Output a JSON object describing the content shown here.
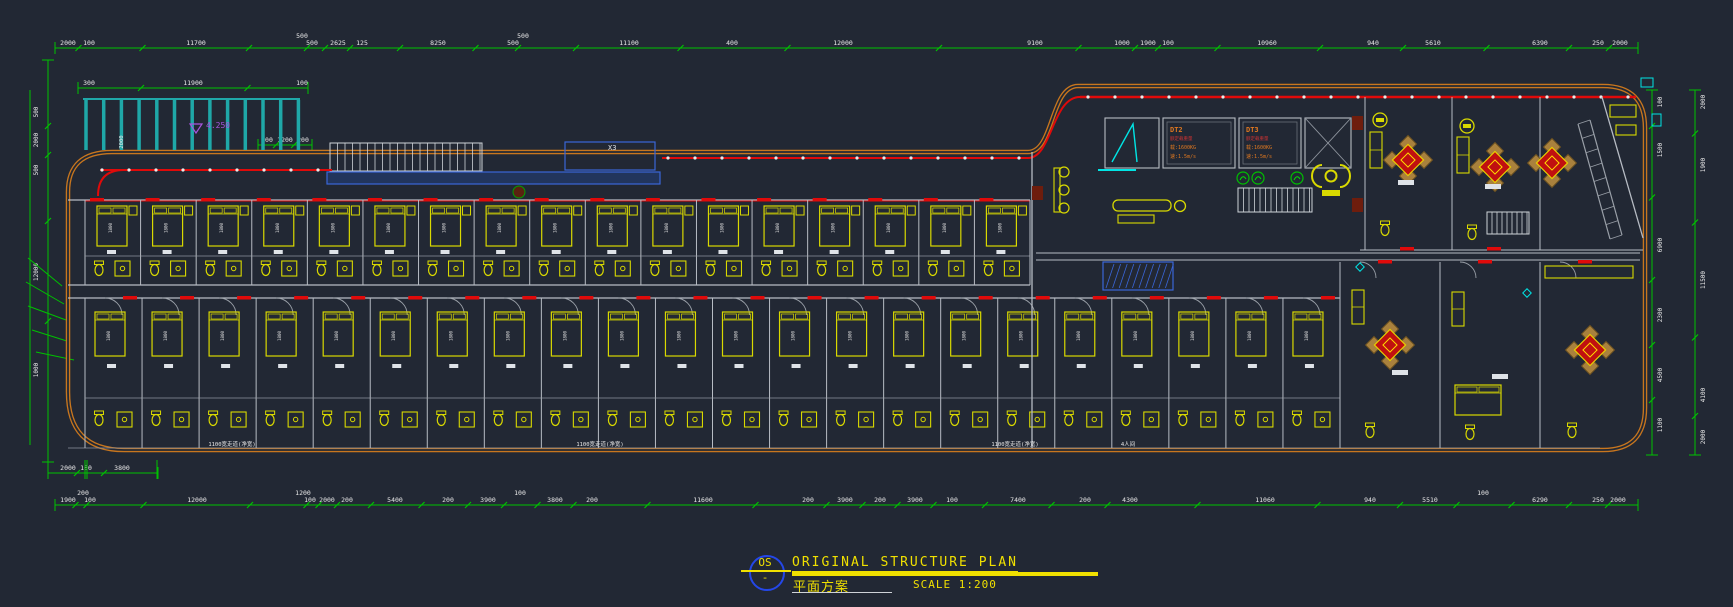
{
  "colors": {
    "bg": "#222834",
    "dim": "#00c200",
    "text": "#e9e9e9",
    "outline": "#c8761e",
    "red": "#e00a0a",
    "yellow": "#d9d900",
    "teal": "#1fa8a8",
    "cyan": "#00e5e5",
    "blue": "#3a66d8",
    "blue_fill": "#223f7d",
    "purple": "#a855e0",
    "wall": "#b7bcc4",
    "tan": "#a9813d",
    "maroon": "#6e1d0d",
    "title_yellow": "#f0e000",
    "circle_blue": "#2447e8",
    "spec_orange": "#e07820",
    "spec_red": "#cc3333"
  },
  "title_block": {
    "code": "OS",
    "dash": "-",
    "title_en": "ORIGINAL STRUCTURE PLAN",
    "title_cn": "平面方案",
    "scale_label": "SCALE 1:200"
  },
  "dims": {
    "top": [
      [
        "2000",
        68
      ],
      [
        "100",
        89
      ],
      [
        "11700",
        196
      ],
      [
        "500",
        302,
        1
      ],
      [
        "500",
        312
      ],
      [
        "2625",
        338
      ],
      [
        "125",
        362
      ],
      [
        "8250",
        438
      ],
      [
        "500",
        513
      ],
      [
        "500",
        523,
        1
      ],
      [
        "11100",
        629
      ],
      [
        "400",
        732
      ],
      [
        "12000",
        843
      ],
      [
        "9100",
        1035
      ],
      [
        "1000",
        1122
      ],
      [
        "1900",
        1148
      ],
      [
        "100",
        1168
      ],
      [
        "10960",
        1267
      ],
      [
        "940",
        1373
      ],
      [
        "5610",
        1433
      ],
      [
        "6390",
        1540
      ],
      [
        "250",
        1598
      ],
      [
        "2000",
        1620
      ]
    ],
    "bottom": [
      [
        "1900",
        68
      ],
      [
        "200",
        83,
        1
      ],
      [
        "100",
        90
      ],
      [
        "12000",
        197
      ],
      [
        "1200",
        303,
        1
      ],
      [
        "100",
        310
      ],
      [
        "2000",
        327
      ],
      [
        "200",
        347
      ],
      [
        "5400",
        395
      ],
      [
        "200",
        448
      ],
      [
        "3900",
        488
      ],
      [
        "100",
        520,
        1
      ],
      [
        "3800",
        555
      ],
      [
        "200",
        592
      ],
      [
        "11600",
        703
      ],
      [
        "200",
        808
      ],
      [
        "3900",
        845
      ],
      [
        "200",
        880
      ],
      [
        "3900",
        915
      ],
      [
        "100",
        952
      ],
      [
        "7400",
        1018
      ],
      [
        "200",
        1085
      ],
      [
        "4300",
        1130
      ],
      [
        "11060",
        1265
      ],
      [
        "940",
        1370
      ],
      [
        "5510",
        1430
      ],
      [
        "100",
        1483,
        1
      ],
      [
        "6290",
        1540
      ],
      [
        "250",
        1598
      ],
      [
        "2000",
        1618
      ]
    ],
    "bottom_small": [
      [
        "2000",
        68
      ],
      [
        "100",
        86
      ],
      [
        "3800",
        122
      ]
    ],
    "left": [
      [
        "500",
        112
      ],
      [
        "2000",
        140
      ],
      [
        "500",
        170
      ],
      [
        "12000",
        272
      ],
      [
        "1000",
        370
      ]
    ],
    "right_inner": [
      [
        "100",
        102
      ],
      [
        "1500",
        150
      ],
      [
        "6900",
        245
      ],
      [
        "2300",
        315
      ],
      [
        "4500",
        375
      ],
      [
        "1100",
        425
      ]
    ],
    "right_outer": [
      [
        "2000",
        102
      ],
      [
        "1900",
        165
      ],
      [
        "11500",
        280
      ],
      [
        "4100",
        395
      ],
      [
        "2000",
        437
      ]
    ],
    "pergola": [
      [
        "300",
        89
      ],
      [
        "11900",
        193
      ],
      [
        "100",
        302
      ]
    ],
    "pergola_inner": [
      [
        "200",
        267
      ],
      [
        "1200",
        285
      ],
      [
        "200",
        303
      ]
    ],
    "pergola_depth": "2000"
  },
  "annotations": {
    "elevation": "4.250",
    "canopy": "X3",
    "bed": "1800",
    "corridor_labels": [
      {
        "t": "1100宽走道(净宽)",
        "x": 232
      },
      {
        "t": "1100宽走道(净宽)",
        "x": 600
      },
      {
        "t": "1100宽走道(净宽)",
        "x": 1015
      },
      {
        "t": "4人间",
        "x": 1128
      }
    ]
  },
  "elevators": [
    {
      "name": "DT2",
      "l1": "额定载重量",
      "l2": "载:1600KG",
      "l3": "速:1.5m/s"
    },
    {
      "name": "DT3",
      "l1": "额定载重量",
      "l2": "载:1600KG",
      "l3": "速:1.5m/s"
    }
  ],
  "plan": {
    "upper_rooms": 17,
    "lower_rooms": 22
  }
}
